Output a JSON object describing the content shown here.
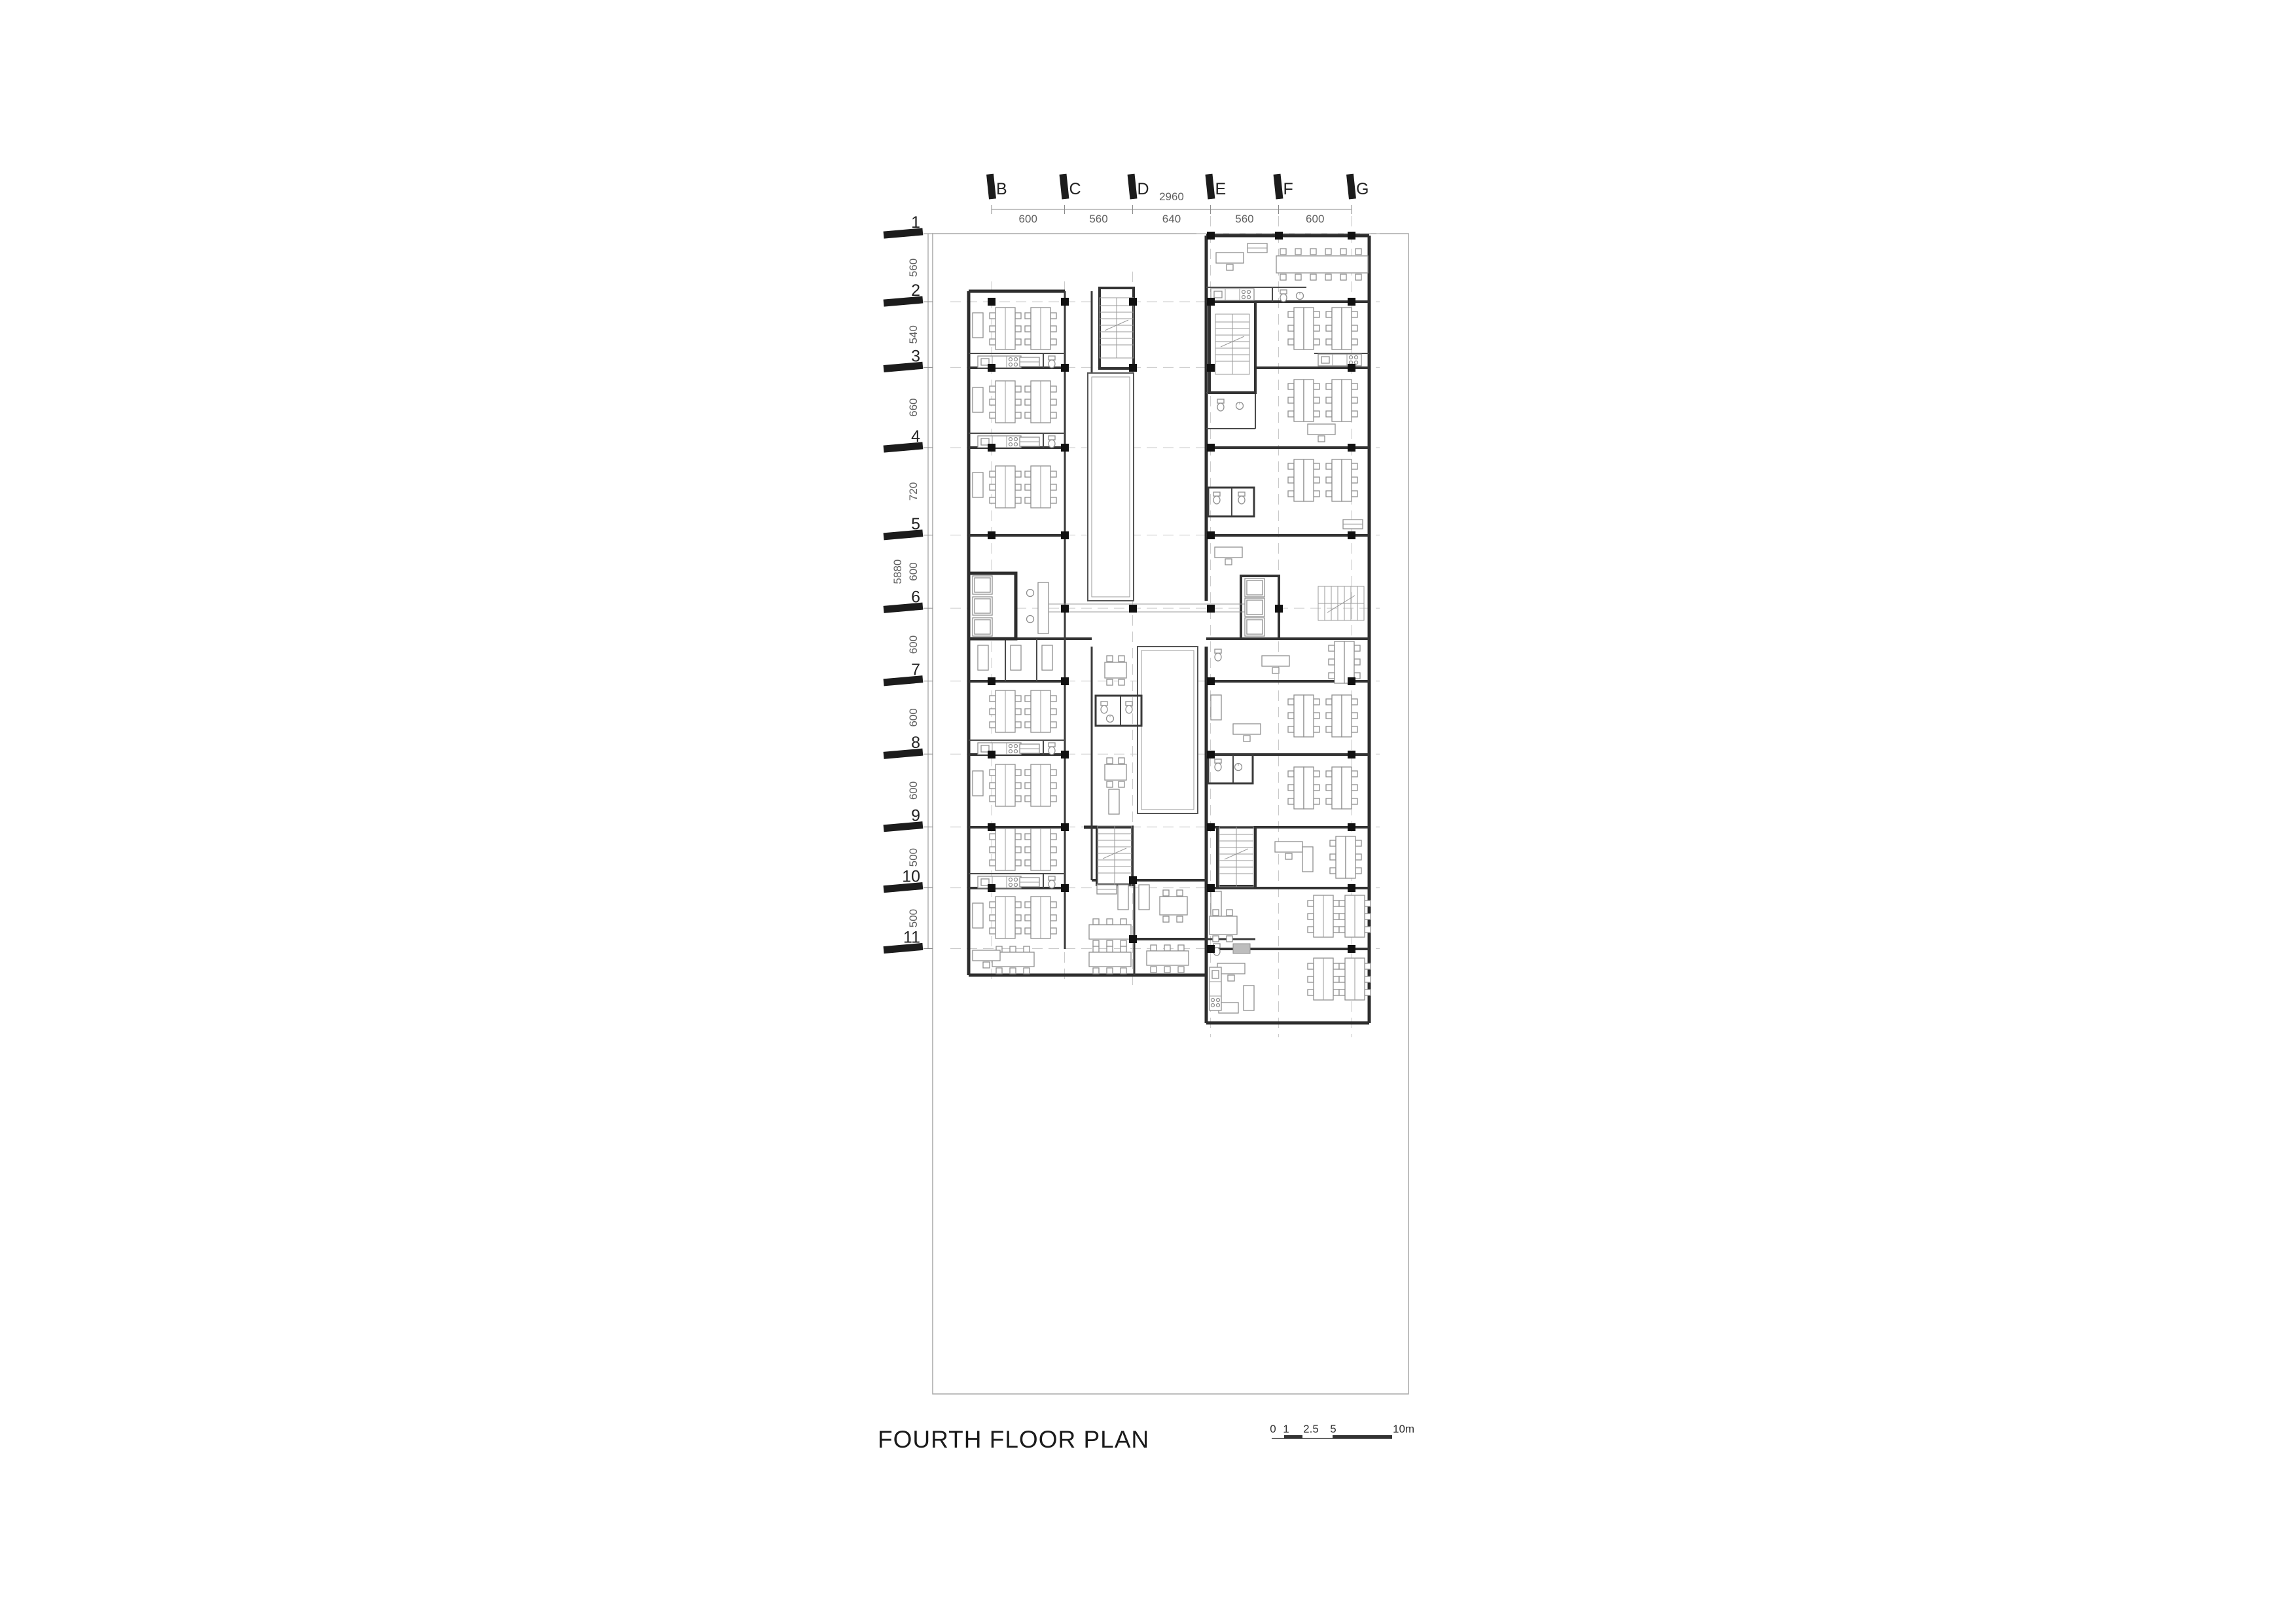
{
  "page": {
    "title": "FOURTH FLOOR PLAN"
  },
  "grid": {
    "columns": {
      "labels": [
        "B",
        "C",
        "D",
        "E",
        "F",
        "G"
      ],
      "spacings": [
        "600",
        "560",
        "640",
        "560",
        "600"
      ],
      "total": "2960"
    },
    "rows": {
      "labels": [
        "1",
        "2",
        "3",
        "4",
        "5",
        "6",
        "7",
        "8",
        "9",
        "10",
        "11"
      ],
      "spacings": [
        "560",
        "540",
        "660",
        "720",
        "600",
        "600",
        "600",
        "600",
        "500",
        "500"
      ],
      "total": "5880"
    }
  },
  "scale_bar": {
    "labels": [
      "0",
      "1",
      "2.5",
      "5",
      "10m"
    ]
  },
  "colors": {
    "wall": "#2d2d2d",
    "furniture": "#8f8f8f",
    "grid_centerline": "#c9c9c9",
    "dimension": "#5f5f5f",
    "tick": "#1c1c1c"
  }
}
